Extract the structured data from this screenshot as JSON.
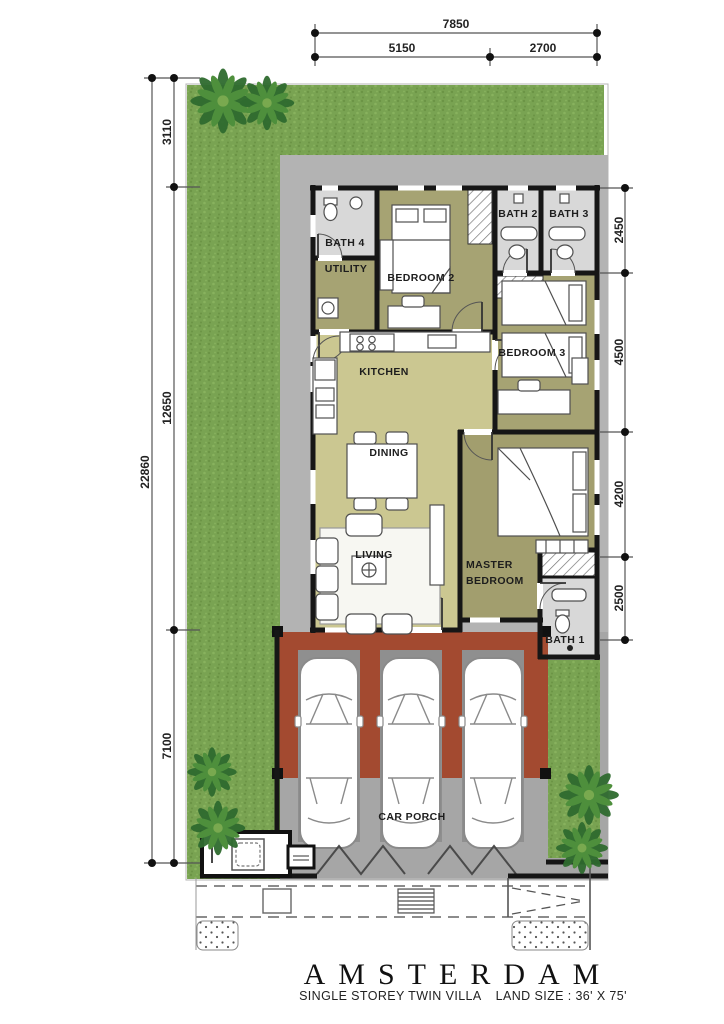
{
  "plan": {
    "title": "AMSTERDAM",
    "subtitle_type": "SINGLE STOREY TWIN VILLA",
    "subtitle_land": "LAND SIZE : 36' X 75'"
  },
  "rooms": {
    "bath4": "BATH 4",
    "utility": "UTILITY",
    "bedroom2": "BEDROOM 2",
    "bath2": "BATH 2",
    "bath3": "BATH 3",
    "kitchen": "KITCHEN",
    "bedroom3": "BEDROOM 3",
    "dining": "DINING",
    "living": "LIVING",
    "master1": "MASTER",
    "master2": "BEDROOM",
    "bath1": "BATH 1",
    "carporch": "CAR PORCH"
  },
  "dimensions": {
    "top": {
      "total": "7850",
      "segments": [
        "5150",
        "2700"
      ]
    },
    "left": {
      "total": "22860",
      "segments": [
        "3110",
        "12650",
        "7100"
      ]
    },
    "right": {
      "segments": [
        "2450",
        "4500",
        "4200",
        "2500"
      ]
    }
  },
  "colors": {
    "grass": "#79a352",
    "grass_dark": "#6b9445",
    "grass_light": "#88b25e",
    "floor_light": "#cbc791",
    "floor_dark": "#a6a373",
    "floor_master": "#a29e6e",
    "bath": "#d8d8d8",
    "porch_red": "#a34a30",
    "apron": "#b3b3b3",
    "driveway": "#a6a6a6",
    "pad": "#8f8f8f",
    "wall": "#161616"
  }
}
